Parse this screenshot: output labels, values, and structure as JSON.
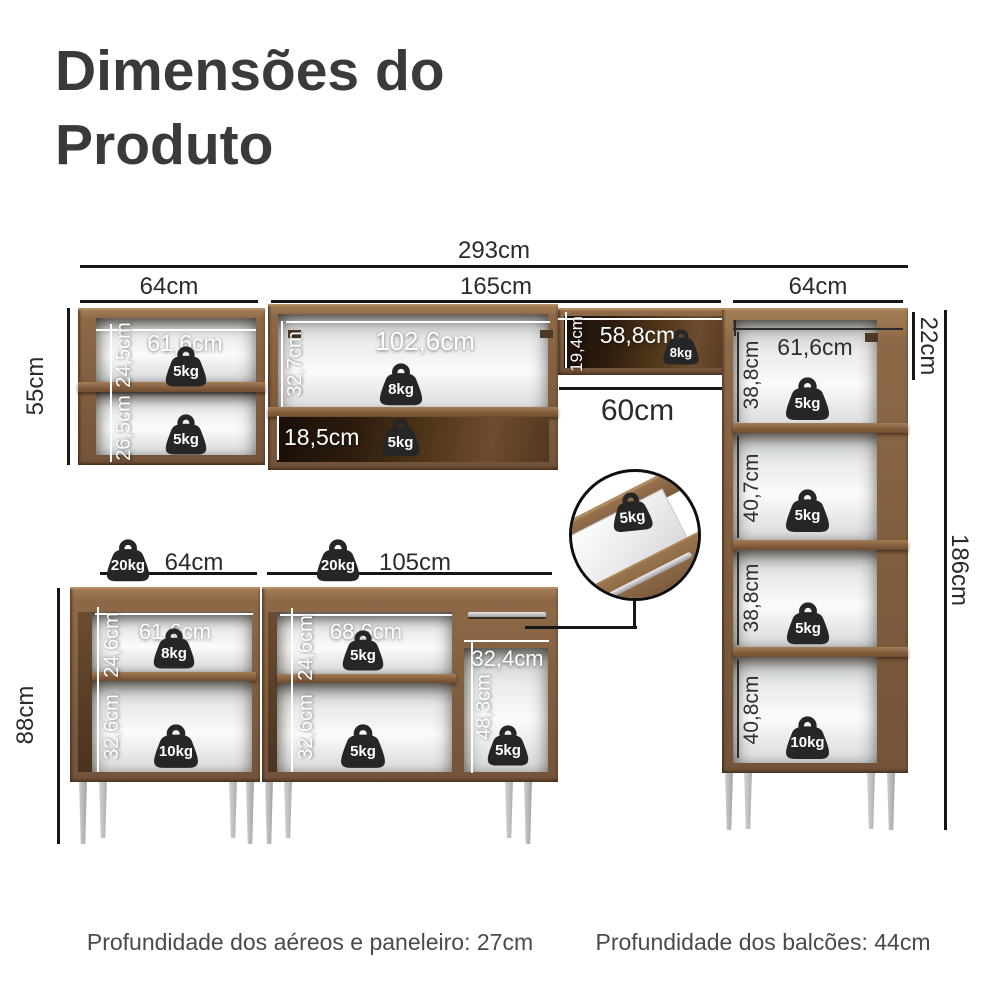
{
  "title": {
    "line1": "Dimensões do",
    "line2": "Produto"
  },
  "overall": {
    "total_width": "293cm",
    "left_width": "64cm",
    "middle_width": "165cm",
    "right_width": "64cm"
  },
  "aereo_left": {
    "height": "55cm",
    "inner_width": "61,6cm",
    "comp1_height": "24,5cm",
    "comp1_load": "5kg",
    "comp2_height": "26,5cm",
    "comp2_load": "5kg"
  },
  "aereo_middle": {
    "inner_width": "102,6cm",
    "comp1_height": "32,7cm",
    "comp1_load": "8kg",
    "comp2_height": "18,5cm",
    "comp2_load": "5kg"
  },
  "nicho": {
    "height": "19,4cm",
    "width": "58,8cm",
    "load": "8kg",
    "gap_below": "60cm"
  },
  "paneleiro": {
    "top_height": "22cm",
    "total_height": "186cm",
    "inner_width": "61,6cm",
    "comp1_height": "38,8cm",
    "comp1_load": "5kg",
    "comp2_height": "40,7cm",
    "comp2_load": "5kg",
    "comp3_height": "38,8cm",
    "comp3_load": "5kg",
    "comp4_height": "40,8cm",
    "comp4_load": "10kg"
  },
  "balcao_left": {
    "width": "64cm",
    "height": "88cm",
    "top_load": "20kg",
    "inner_width": "61,6cm",
    "comp1_height": "24,6cm",
    "comp1_load": "8kg",
    "comp2_height": "32,6cm",
    "comp2_load": "10kg"
  },
  "balcao_middle": {
    "width": "105cm",
    "top_load": "20kg",
    "inner_width": "68,6cm",
    "comp1_height": "24,6cm",
    "comp1_load": "5kg",
    "comp2_height": "32,6cm",
    "comp2_load": "5kg",
    "niche_width": "32,4cm",
    "niche_height": "48,3cm",
    "niche_load": "5kg",
    "drawer_load": "5kg"
  },
  "footer": {
    "left": "Profundidade dos aéreos e paneleiro: 27cm",
    "right": "Profundidade dos balcões: 44cm"
  },
  "colors": {
    "background": "#ffffff",
    "wood": "#8a6747",
    "wood_dark": "#3a2718",
    "dimension_line": "#161616",
    "weight_icon": "#262626",
    "text": "#2b2b2b"
  }
}
